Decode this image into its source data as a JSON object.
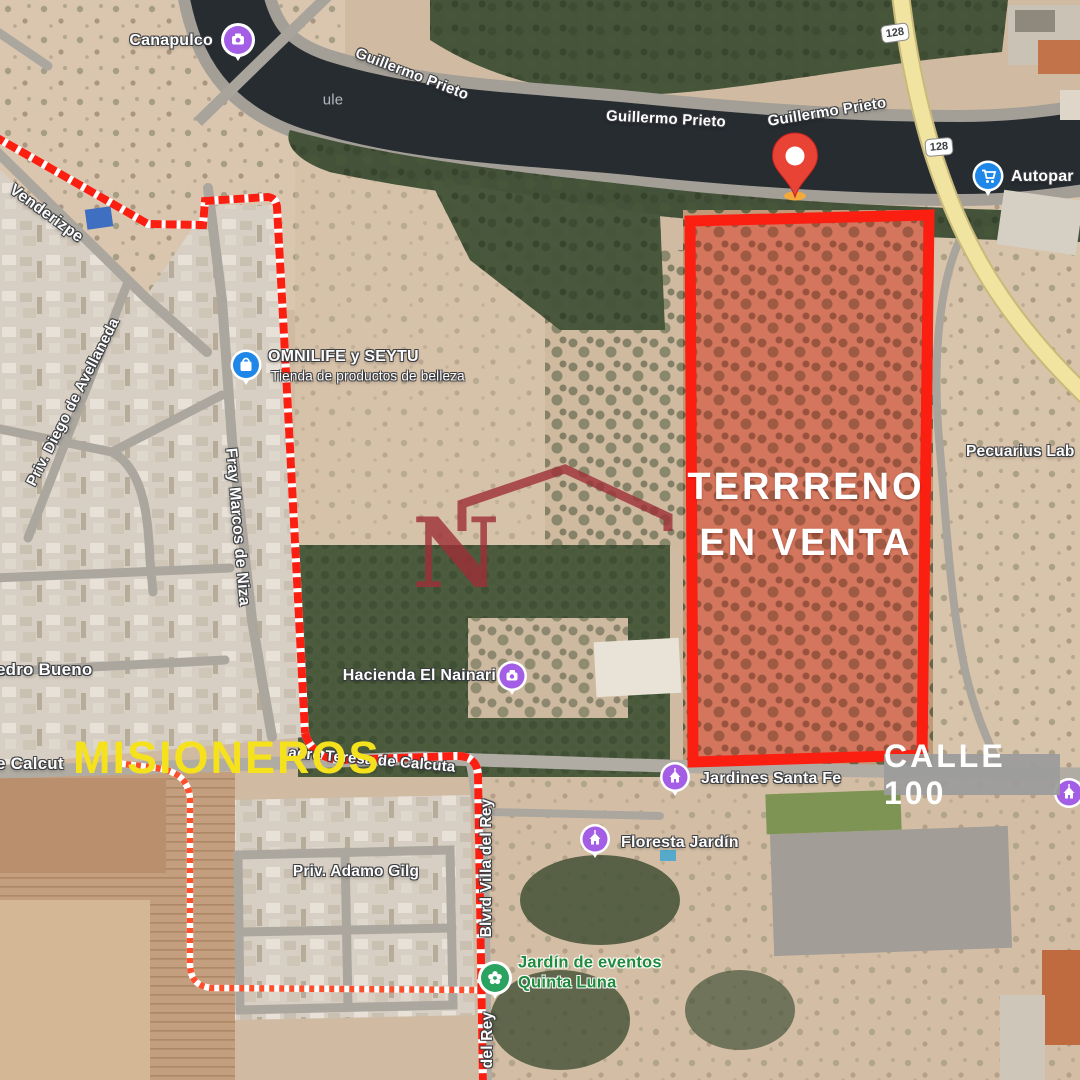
{
  "annotations": {
    "terreno_line1": "TERRRENO",
    "terreno_line2": "EN VENTA",
    "misioneros": "MISIONEROS",
    "calle100": "CALLE 100",
    "watermark_letter": "N",
    "map_watermark_fragment": "ule"
  },
  "highway_shields": {
    "north": "128",
    "south": "128"
  },
  "pois": {
    "canapulco": {
      "name": "Canapulco",
      "icon": "camera-icon"
    },
    "omnilife": {
      "name": "OMNILIFE y SEYTU",
      "subtitle": "Tienda de productos de belleza",
      "icon": "shopping-bag-icon"
    },
    "autopartes": {
      "name": "Autopar",
      "icon": "shopping-cart-icon"
    },
    "pecuarius": {
      "name": "Pecuarius Lab"
    },
    "hacienda": {
      "name": "Hacienda El Nainari",
      "icon": "camera-icon"
    },
    "jardines_santa_fe": {
      "name": "Jardines Santa Fe",
      "icon": "landmark-icon"
    },
    "floresta": {
      "name": "Floresta Jardín",
      "icon": "landmark-icon"
    },
    "quinta_luna": {
      "line1": "Jardín de eventos",
      "line2": "Quinta Luna",
      "icon": "flower-icon"
    }
  },
  "streets": {
    "guillermo_prieto": "Guillermo Prieto",
    "venderizpe": "Venderizpe",
    "avellaneda": "Priv. Diego de Avellaneda",
    "fray_marcos": "Fray Marcos de Niza",
    "pedro_bueno": "edro Bueno",
    "calcuta_left": "e Calcut",
    "teresa_calcuta": "adre Teresa de Calcuta",
    "adamo_gilg": "Priv. Adamo Gilg",
    "blvrd_villa": "Blvrd Villa del Rey",
    "del_rey": "del Rey"
  },
  "markers": {
    "sale_pin": "red-location-pin"
  },
  "colors": {
    "boundary_red": "#fb1f12",
    "parcel_fill": "rgba(233,75,60,0.44)",
    "pin_red": "#E94335",
    "misioneros_yellow": "#F5E21D",
    "calle_box_gray": "#9b9b9b",
    "poi_purple": "#A45EE5",
    "poi_blue": "#1F87E8",
    "poi_green": "#2AA360",
    "highway_yellow": "#F0E4A0"
  }
}
